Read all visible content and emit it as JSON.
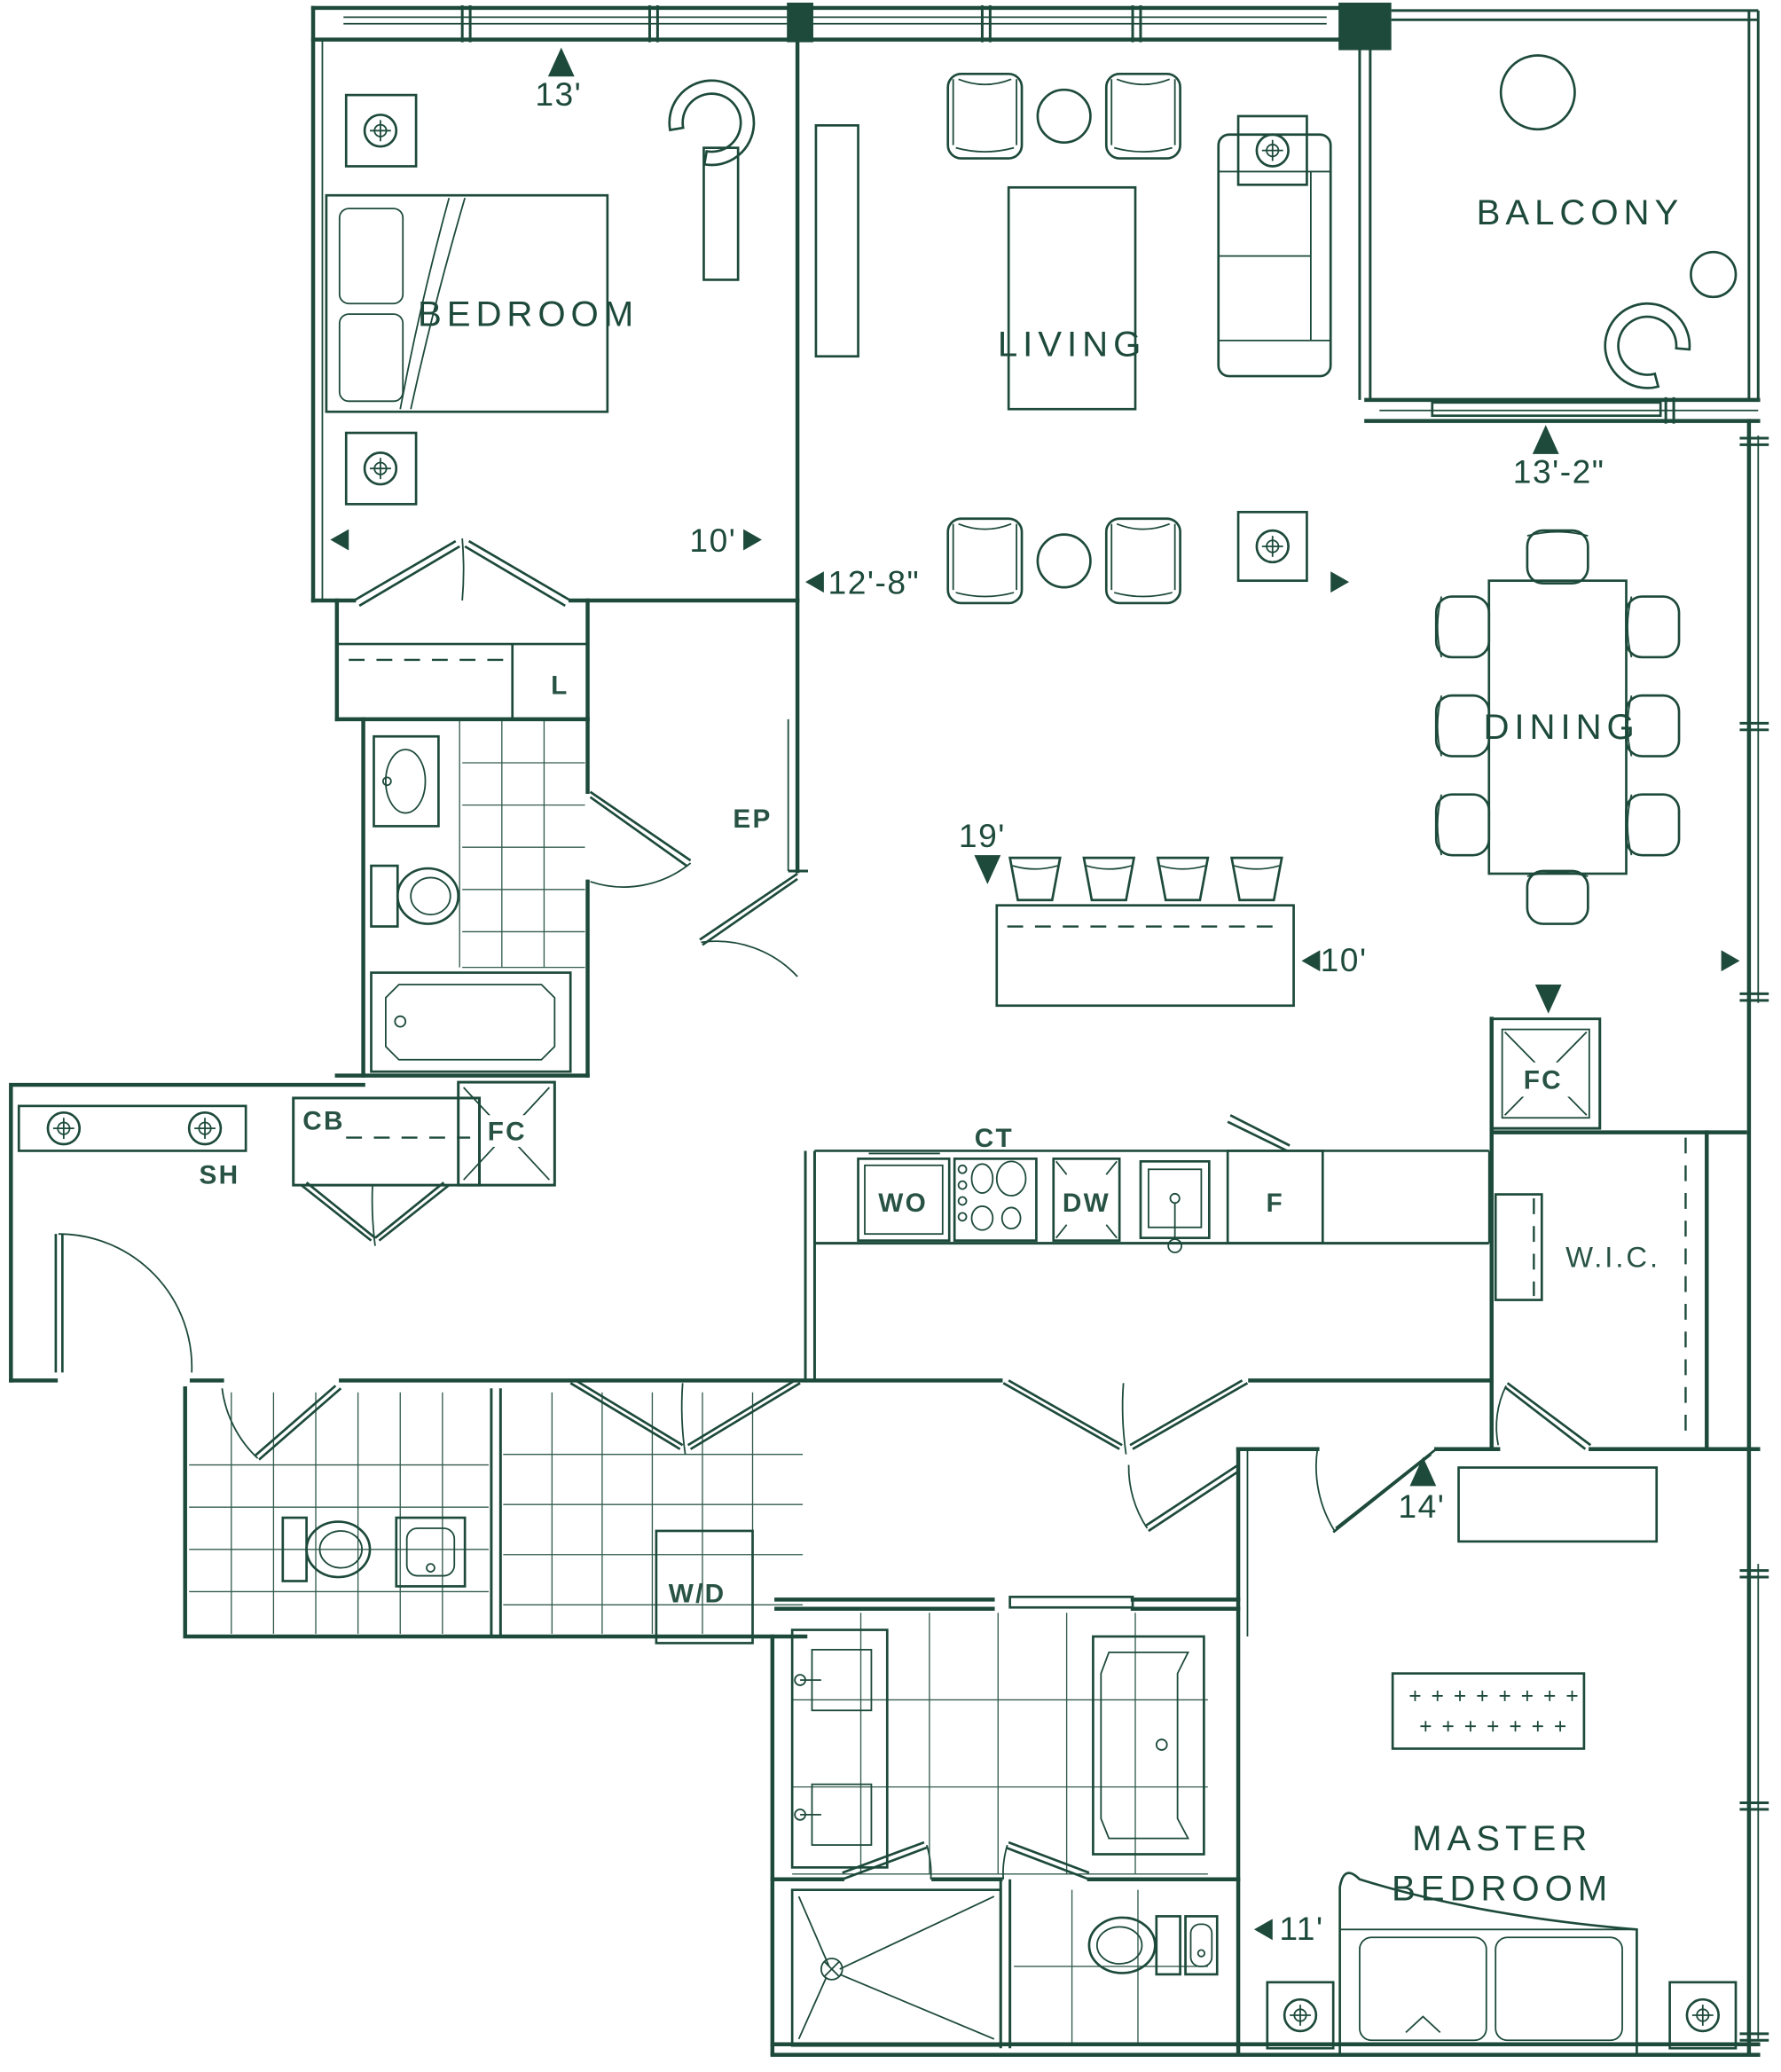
{
  "colors": {
    "line": "#1d4a3a",
    "background": "#ffffff"
  },
  "rooms": {
    "bedroom": "BEDROOM",
    "living": "LIVING",
    "balcony": "BALCONY",
    "dining": "DINING",
    "wic": "W.I.C.",
    "master_line1": "MASTER",
    "master_line2": "BEDROOM"
  },
  "dimensions": {
    "bedroom_width": "13'",
    "bedroom_depth": "10'",
    "living_width": "12'-8\"",
    "balcony_width": "13'-2\"",
    "kitchen_length": "19'",
    "island_length": "10'",
    "master_width": "14'",
    "ensuite_width": "11'"
  },
  "fixtures": {
    "linen": "L",
    "electrical_panel": "EP",
    "closet": "CB",
    "fan_coil_hall": "FC",
    "fan_coil_kitchen": "FC",
    "shelf": "SH",
    "cooktop": "CT",
    "wall_oven": "WO",
    "dishwasher": "DW",
    "fridge": "F",
    "washer_dryer": "W/D"
  }
}
